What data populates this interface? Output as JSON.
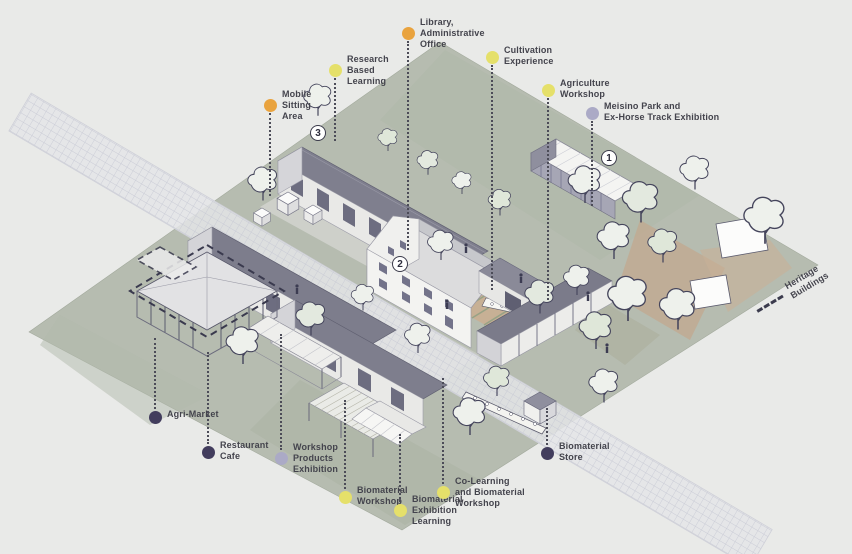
{
  "colors": {
    "orange": "#E9A33E",
    "yellow": "#E5E06A",
    "lavender": "#ABAAC6",
    "purple": "#423D5D",
    "text": "#44444D",
    "leader": "#4C4C58"
  },
  "callouts": [
    {
      "id": "library-administrative-office",
      "lines": [
        "Library,",
        "Administrative",
        "Office"
      ],
      "color": "orange",
      "dot": {
        "x": 408,
        "y": 33
      },
      "direction": "down",
      "leader_end_y": 250
    },
    {
      "id": "research-based-learning",
      "lines": [
        "Research",
        "Based",
        "Learning"
      ],
      "color": "yellow",
      "dot": {
        "x": 335,
        "y": 70
      },
      "direction": "down",
      "leader_end_y": 141
    },
    {
      "id": "mobile-sitting-area",
      "lines": [
        "Mobile",
        "Sitting",
        "Area"
      ],
      "color": "orange",
      "dot": {
        "x": 270,
        "y": 105
      },
      "direction": "down",
      "leader_end_y": 196
    },
    {
      "id": "cultivation-experience",
      "lines": [
        "Cultivation",
        "Experience"
      ],
      "color": "yellow",
      "dot": {
        "x": 492,
        "y": 57
      },
      "direction": "down",
      "leader_end_y": 290
    },
    {
      "id": "agriculture-workshop",
      "lines": [
        "Agriculture",
        "Workshop"
      ],
      "color": "yellow",
      "dot": {
        "x": 548,
        "y": 90
      },
      "direction": "down",
      "leader_end_y": 300
    },
    {
      "id": "meisino-park-ex-horse-track-exhibition",
      "lines": [
        "Meisino Park and",
        "Ex-Horse Track Exhibition"
      ],
      "color": "lavender",
      "dot": {
        "x": 592,
        "y": 113
      },
      "direction": "down",
      "leader_end_y": 206
    },
    {
      "id": "agri-market",
      "lines": [
        "Agri-Market"
      ],
      "color": "purple",
      "dot": {
        "x": 155,
        "y": 417
      },
      "direction": "up",
      "leader_end_y": 338
    },
    {
      "id": "restaurant-cafe",
      "lines": [
        "Restaurant",
        "Cafe"
      ],
      "color": "purple",
      "dot": {
        "x": 208,
        "y": 452
      },
      "direction": "up",
      "leader_end_y": 352
    },
    {
      "id": "workshop-products-exhibition",
      "lines": [
        "Workshop",
        "Products",
        "Exhibition"
      ],
      "color": "lavender",
      "dot": {
        "x": 281,
        "y": 458
      },
      "direction": "up",
      "leader_end_y": 334
    },
    {
      "id": "biomaterial-workshop",
      "lines": [
        "Biomaterial",
        "Workshop"
      ],
      "color": "yellow",
      "dot": {
        "x": 345,
        "y": 497
      },
      "direction": "up",
      "leader_end_y": 400
    },
    {
      "id": "biomaterial-exhibition-learning",
      "lines": [
        "Biomaterial",
        "Exhibition",
        "Learning"
      ],
      "color": "yellow",
      "dot": {
        "x": 400,
        "y": 510
      },
      "direction": "up",
      "leader_end_y": 434
    },
    {
      "id": "co-learning-and-biomaterial-workshop",
      "lines": [
        "Co-Learning",
        "and Biomaterial",
        "Workshop"
      ],
      "color": "yellow",
      "dot": {
        "x": 443,
        "y": 492
      },
      "direction": "up",
      "leader_end_y": 378
    },
    {
      "id": "biomaterial-store",
      "lines": [
        "Biomaterial",
        "Store"
      ],
      "color": "purple",
      "dot": {
        "x": 547,
        "y": 453
      },
      "direction": "up",
      "leader_end_y": 408
    }
  ],
  "building_numbers": [
    {
      "label": "1",
      "x": 609,
      "y": 158
    },
    {
      "label": "2",
      "x": 400,
      "y": 264
    },
    {
      "label": "3",
      "x": 318,
      "y": 133
    }
  ],
  "legend": {
    "id": "heritage-buildings",
    "lines": [
      "Heritage",
      "Buildings"
    ],
    "x": 757,
    "y": 300,
    "rotation": -31
  }
}
